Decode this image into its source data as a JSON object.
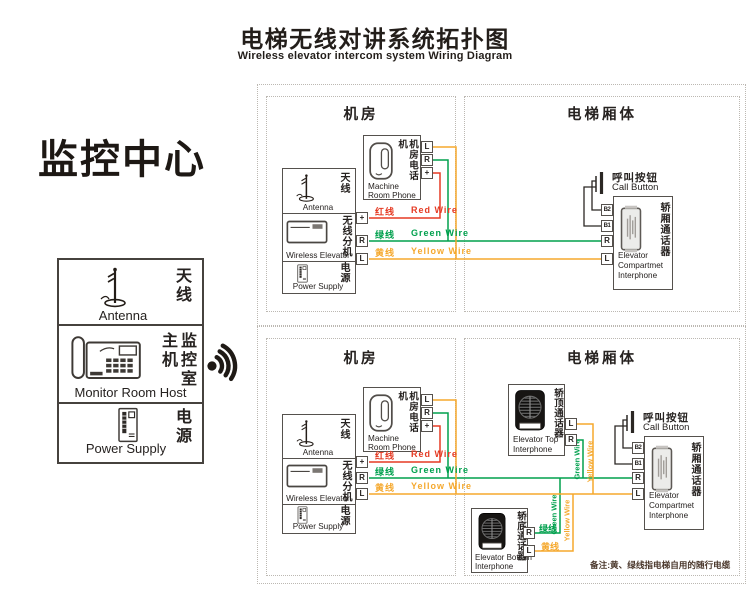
{
  "title": {
    "zh": "电梯无线对讲系统拓扑图",
    "en": "Wireless elevator intercom system Wiring Diagram"
  },
  "monitor": {
    "heading": "监控中心",
    "antenna": {
      "zh": "天线",
      "en": "Antenna"
    },
    "host": {
      "zh": "监控室主机",
      "en": "Monitor Room Host"
    },
    "power": {
      "zh": "电源",
      "en": "Power Supply"
    }
  },
  "regions": {
    "machine_room": "机房",
    "elevator_car": "电梯厢体"
  },
  "machine_phone": {
    "zh": "机房电话机",
    "en1": "Machine",
    "en2": "Room Phone",
    "t_l": "L",
    "t_r": "R",
    "t_plus": "+"
  },
  "unit": {
    "antenna_zh": "天线",
    "antenna_en": "Antenna",
    "ext_zh": "无线分机",
    "ext_en": "Wireless Elevator",
    "power_zh": "电源",
    "power_en": "Power Supply",
    "t_plus": "+",
    "t_r": "R",
    "t_l": "L"
  },
  "wires": {
    "red_zh": "红线",
    "red_en": "Red Wire",
    "green_zh": "绿线",
    "green_en": "Green Wire",
    "yellow_zh": "黄线",
    "yellow_en": "Yellow Wire"
  },
  "call_button": {
    "zh": "呼叫按钮",
    "en": "Call Button"
  },
  "compartment": {
    "zh": "轿厢通话器",
    "en1": "Elevator",
    "en2": "Compartmet",
    "en3": "Interphone",
    "t_b2": "B2",
    "t_b1": "B1",
    "t_r": "R",
    "t_l": "L"
  },
  "top_interphone": {
    "zh": "轿顶通话器",
    "en1": "Elevator Top",
    "en2": "Interphone",
    "t_l": "L",
    "t_r": "R"
  },
  "bottom_interphone": {
    "zh": "轿底通话器",
    "en1": "Elevator Bottom",
    "en2": "Interphone",
    "t_r": "R",
    "t_l": "L"
  },
  "note": "备注:黄、绿线指电梯自用的随行电缆",
  "colors": {
    "red": "#e53a23",
    "green": "#00a04d",
    "yellow": "#f5a82d",
    "line": "#2b2724"
  }
}
